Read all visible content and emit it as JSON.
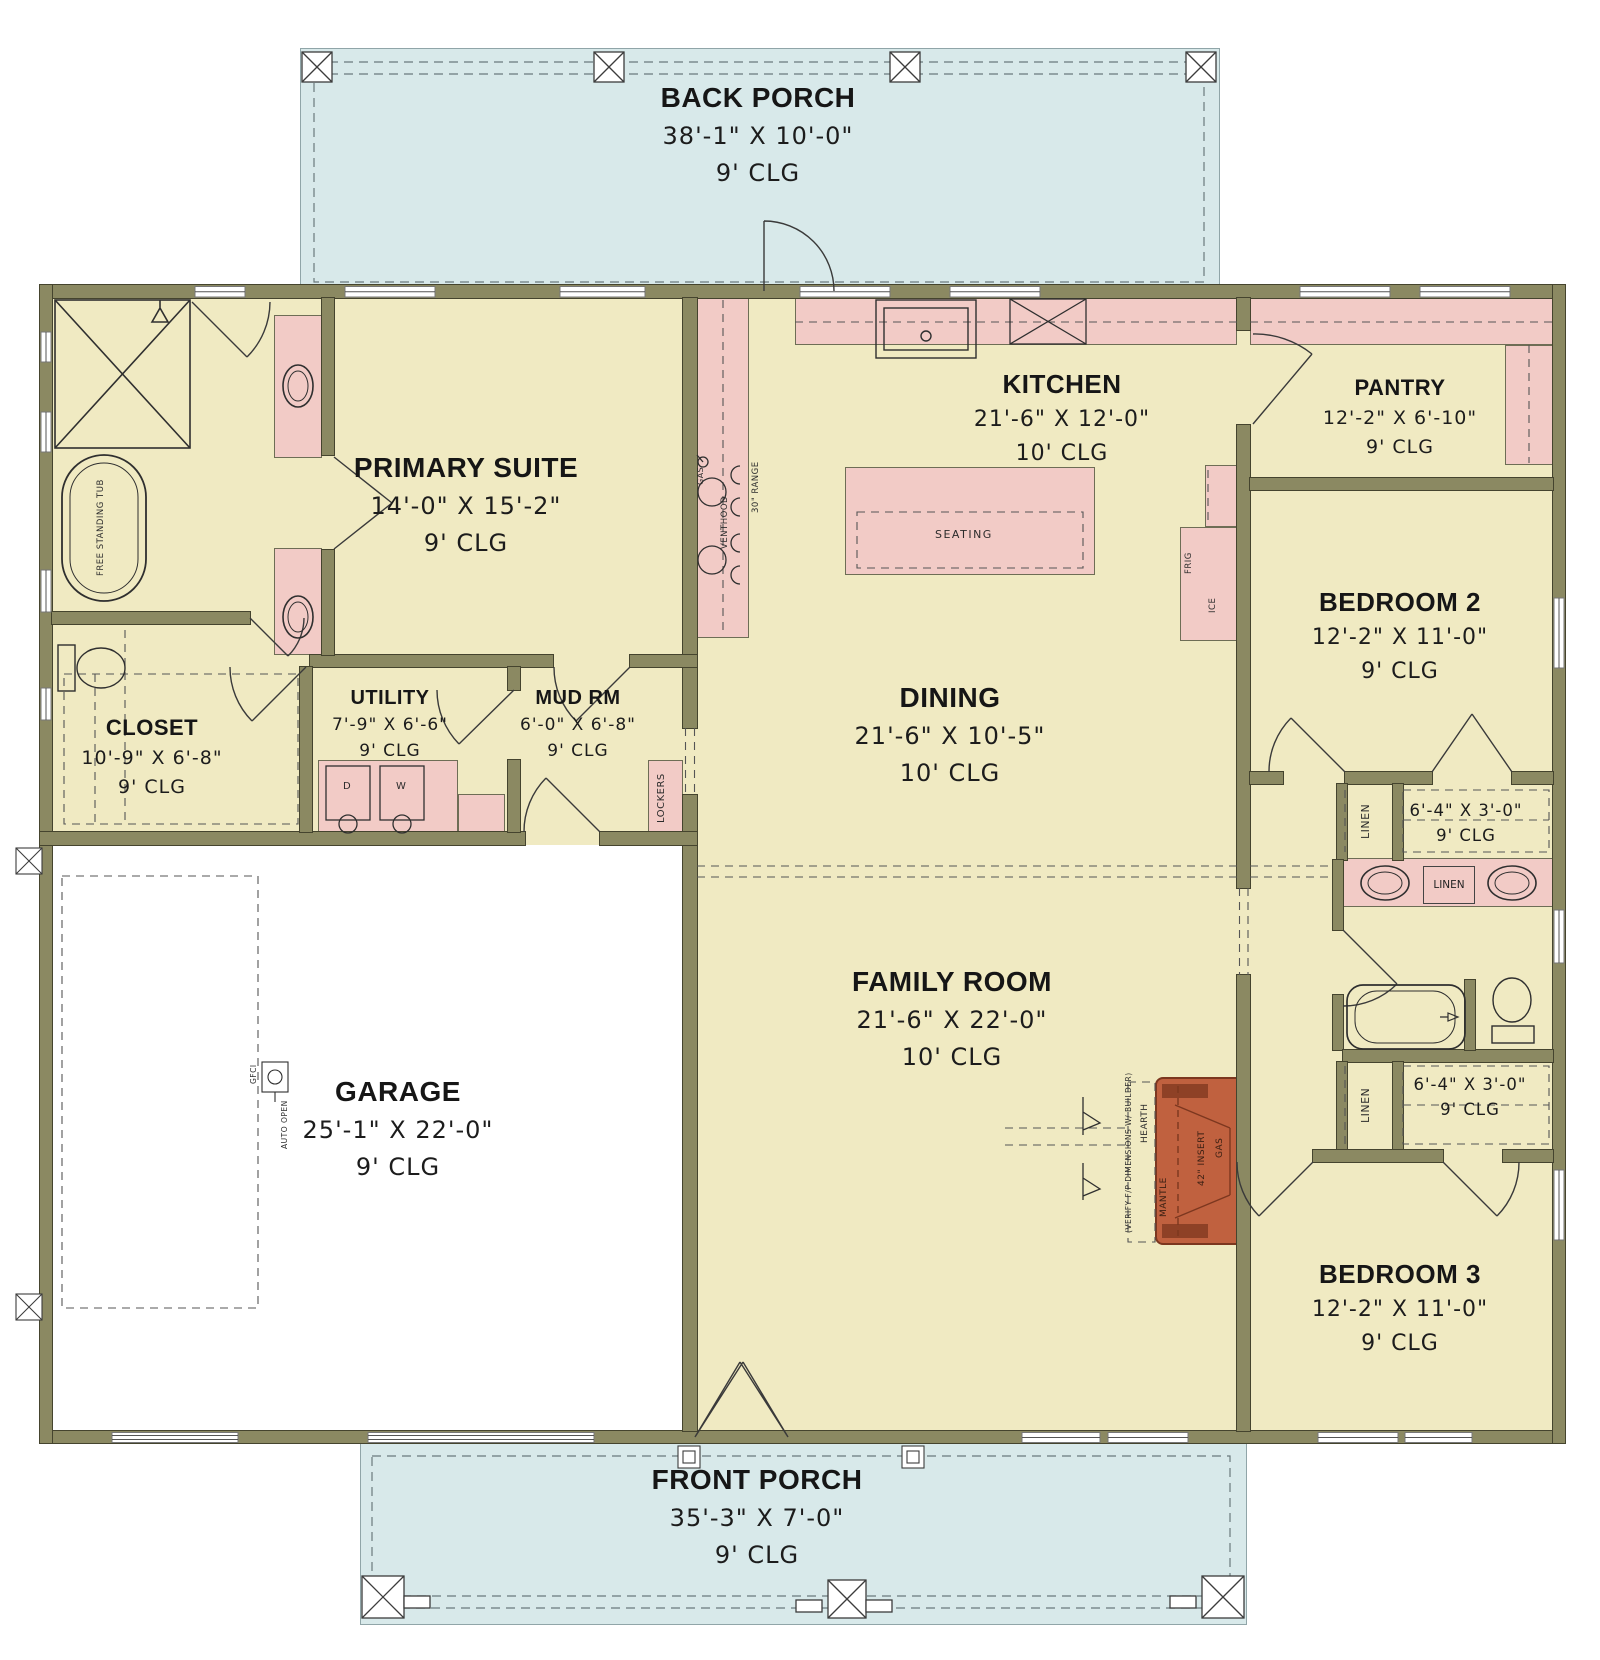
{
  "plan_title": "Single-story house floor plan",
  "rooms": {
    "back_porch": {
      "name": "BACK PORCH",
      "dims": "38'-1\" X 10'-0\"",
      "clg": "9' CLG"
    },
    "primary_suite": {
      "name": "PRIMARY SUITE",
      "dims": "14'-0\" X 15'-2\"",
      "clg": "9' CLG"
    },
    "kitchen": {
      "name": "KITCHEN",
      "dims": "21'-6\" X 12'-0\"",
      "clg": "10' CLG"
    },
    "pantry": {
      "name": "PANTRY",
      "dims": "12'-2\" X 6'-10\"",
      "clg": "9' CLG"
    },
    "bedroom2": {
      "name": "BEDROOM 2",
      "dims": "12'-2\" X 11'-0\"",
      "clg": "9' CLG"
    },
    "closet": {
      "name": "CLOSET",
      "dims": "10'-9\" X 6'-8\"",
      "clg": "9' CLG"
    },
    "utility": {
      "name": "UTILITY",
      "dims": "7'-9\" X 6'-6\"",
      "clg": "9' CLG"
    },
    "mud_rm": {
      "name": "MUD RM",
      "dims": "6'-0\" X 6'-8\"",
      "clg": "9' CLG"
    },
    "dining": {
      "name": "DINING",
      "dims": "21'-6\" X 10'-5\"",
      "clg": "10' CLG"
    },
    "family_room": {
      "name": "FAMILY ROOM",
      "dims": "21'-6\" X 22'-0\"",
      "clg": "10' CLG"
    },
    "garage": {
      "name": "GARAGE",
      "dims": "25'-1\" X 22'-0\"",
      "clg": "9' CLG"
    },
    "bedroom3": {
      "name": "BEDROOM 3",
      "dims": "12'-2\" X 11'-0\"",
      "clg": "9' CLG"
    },
    "front_porch": {
      "name": "FRONT PORCH",
      "dims": "35'-3\" X 7'-0\"",
      "clg": "9' CLG"
    },
    "hall_closet_upper": {
      "dims": "6'-4\" X 3'-0\"",
      "clg": "9' CLG"
    },
    "hall_closet_lower": {
      "dims": "6'-4\" X 3'-0\"",
      "clg": "9' CLG"
    }
  },
  "fixtures": {
    "seating": "SEATING",
    "lockers": "LOCKERS",
    "frig": "FRIG",
    "ice": "ICE",
    "gas": "GAS",
    "venthood": "VENTHOOD",
    "range": "30\" RANGE",
    "free_standing_tub": "FREE STANDING TUB",
    "linen": "LINEN",
    "dryer": "D",
    "washer": "W",
    "gfci": "GFCI",
    "auto_open": "AUTO OPEN",
    "mantle": "MANTLE",
    "insert": "42\" INSERT",
    "fp_gas": "GAS",
    "hearth": "HEARTH",
    "verify_note": "(VERIFY F/P DIMENSIONS W/ BUILDER)"
  },
  "colors": {
    "floor": "#f0eac2",
    "porch": "#d8e9ea",
    "casework_pink": "#f2cbc6",
    "wall": "#8b8962",
    "fireplace": "#c0613f",
    "garage_floor": "#ffffff"
  }
}
